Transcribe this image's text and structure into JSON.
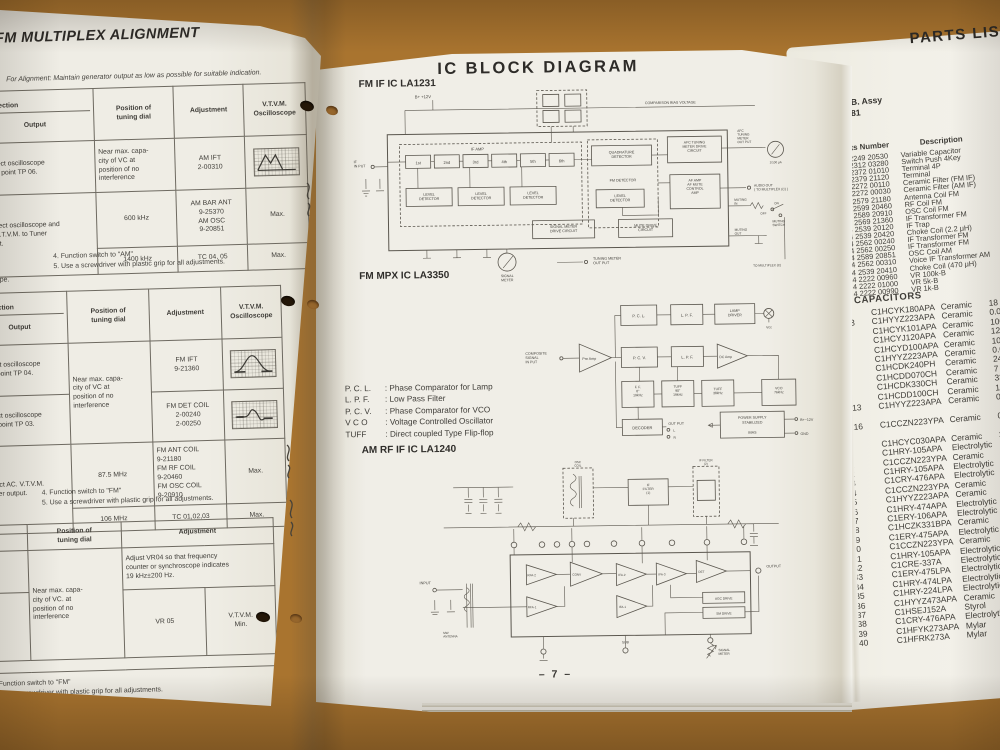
{
  "left_page": {
    "title": "FM MULTIPLEX ALIGNMENT",
    "alignment_note": "For Alignment: Maintain generator output as low as possible for suitable indication.",
    "cut_fragment": "ope.",
    "am_table": {
      "col_connection": "Connection",
      "col_output": "Output",
      "col_position": "Position of\ntuning dial",
      "col_adjustment": "Adjustment",
      "col_vtvm": "V.T.V.M.\nOscilloscope",
      "r1_connection": "Connect oscilloscope\nto test point TP 06.",
      "r1_position": "Near max. capa-\ncity of VC at\nposition of no\ninterference",
      "r1_adjustment": "AM IFT\n2-00310",
      "r2_connection": "Connect oscilloscope and\nAC. V.T.V.M. to Tuner\noutput.",
      "r2_position": "600 kHz",
      "r2_adjustment": "AM BAR ANT\n9-25370\nAM OSC\n9-20851",
      "r2_vtvm": "Max.",
      "r3_position": "1400 kHz",
      "r3_adjustment": "TC 04, 05",
      "r3_vtvm": "Max.",
      "footnote4": "4.  Function switch to \"AM\"",
      "footnote5": "5.  Use a screwdriver with plastic grip for all adjustments."
    },
    "fm_table": {
      "col_connection": "Connection",
      "col_output": "Output",
      "col_position": "Position of\ntuning dial",
      "col_adjustment": "Adjustment",
      "col_vtvm": "V.T.V.M.\nOscilloscope",
      "r1_connection": "Connect oscilloscope\nto test point TP 04.",
      "r1_position": "Near max. capa-\ncity of VC at\nposition of no\ninterference",
      "r1_adjustment": "FM IFT\n9-21360",
      "r2_connection": "Connect oscilloscope\nto test point TP 03.",
      "r2_adjustment": "FM DET COIL\n2-00240\n2-00250",
      "r3_connection": "Connect AC. V.T.V.M.\nto Tuner output.",
      "r3_position": "87.5 MHz",
      "r3_adjustment": "FM ANT COIL\n9-21180\nFM RF COIL\n9-20460\nFM OSC COIL\n9-20910",
      "r3_vtvm": "Max.",
      "r4_position": "106 MHz",
      "r4_adjustment": "TC 01,02,03",
      "r4_vtvm": "Max.",
      "footnote4": "4.  Function switch to \"FM\"",
      "footnote5": "5.  Use a screwdriver with plastic grip for all adjustments."
    },
    "mpx_table": {
      "col_position": "Position of\ntuning dial",
      "col_adjustment": "Adjustment",
      "r1_adjustment": "Adjust VR04 so that frequency\ncounter or synchroscope indicates\n19 kHz±200 Hz.",
      "r2_position": "Near max. capa-\ncity of VC. at\nposition of no\ninterference",
      "r2_adjustment": "VR 05",
      "r2_vtvm": "V.T.V.M.\nMin.",
      "footnote4": "4.  Function switch to \"FM\"",
      "footnote5": "5.  Use a screwdriver with plastic grip for all adjustments."
    }
  },
  "center_page": {
    "title": "IC BLOCK DIAGRAM",
    "page_number": "– 7 –",
    "la1231": {
      "heading": "FM IF IC LA1231",
      "b_plus": "B+  +12V",
      "comparison": "COMPARISON  BIAS  VOLTAGE",
      "if_input": "IF\nIN PUT",
      "if_amp": "IF  AMP",
      "stages": [
        "1st",
        "2nd",
        "3rd",
        "4th",
        "5th",
        "6th"
      ],
      "level_detector": "LEVEL\nDETECTOR",
      "quadrature": "QUADRATURE\nDETECTOR",
      "fm_detector": "FM  DETECTOR",
      "afc_block": "AFC TUNING\nMETER DRIVE\nCIRCUIT",
      "af_block": "AF  AMP\nAF MUTE\nCONTROL\nAMP",
      "sig_drive": "SIGNAL METER\nDRIVE CIRCUIT",
      "mute_drive": "MUTE DRIVE\nCIRCUIT",
      "signal_meter": "SIGNAL\nMETER",
      "tuning_meter_out": "TUNING  METER\nOUT PUT",
      "afc_out": "AFC\nTUNING\nMETER\nOUT PUT",
      "meter_scale": "1/100 μA",
      "audio_out": "AUDIO OUT\n( TO MULTIPLEX (C) )",
      "muting_in": "MUTING\nIN",
      "on": "ON",
      "off": "OFF",
      "muting_switch": "MUTING\nSWITCH",
      "muting_out": "MUTING\nOUT",
      "to_multiplex": "TO MULTIPLEX (C)"
    },
    "la3350": {
      "heading": "FM MPX IC LA3350",
      "composite": "COMPOSITE\nSIGNAL\nIN PUT",
      "pre_amp": "Pre Amp",
      "pcl": "P. C. L.",
      "lpf1": "L. P. F.",
      "lamp_driver": "LAMP\nDRIVER",
      "vcc": "Vcc",
      "pcv": "P. C. V.",
      "lpf2": "L. P. F.",
      "dc_amp": "DC Amp",
      "ff": "F. F.\n0°\n19kHz",
      "tuff90": "TUFF\n90°\n19kHz",
      "tuff38": "TUFF\n38kHz",
      "vco": "VCO\n76kHz",
      "decoder": "DECODER",
      "out_put": "OUT PUT",
      "out_l": "L",
      "out_r": "R",
      "power1": "POWER SUPPLY",
      "power2": "STABILIZED",
      "bias": "BIAS",
      "b12v": "B+~12V",
      "gnd": "GND"
    },
    "legend": [
      {
        "t": "P. C. L.",
        "d": ": Phase Comparator for Lamp"
      },
      {
        "t": "L. P. F.",
        "d": ": Low Pass Filter"
      },
      {
        "t": "P. C. V.",
        "d": ": Phase Comparator for VCO"
      },
      {
        "t": "V C O",
        "d": ": Voltage Controlled Oscillator"
      },
      {
        "t": "TUFF",
        "d": ": Direct coupled Type Flip-flop"
      }
    ],
    "la1240": {
      "heading": "AM RF IF IC LA1240",
      "input": "INPUT",
      "mw_antenna": "MW\nANTENNA",
      "osc_coil": "OSC\nCOIL",
      "if_filter1": "IF\nFILTER\n(1)",
      "if_filter2": "IF FILTER\n(2)",
      "rfa2": "RFA-2",
      "rfa1": "RFA-1",
      "conv": "CONV",
      "ifa2": "IFA-2",
      "ifa1": "IFA-1",
      "ifa3": "IFA-3",
      "det": "DET",
      "agc": "AGC DRIVE",
      "sm": "SM DRIVE",
      "sub": "SUB",
      "signal_meter": "SIGNAL\nMETER",
      "output": "OUTPUT"
    }
  },
  "right_page": {
    "title": "PARTS LIST",
    "assy_name": "RF/IF/MPX P.C.B. Assy",
    "assy_number": "131 0 4001 08781",
    "col_ref": "Ref.  No.",
    "col_part": "Parts Number",
    "col_desc": "Description",
    "parts": [
      [
        "",
        "4 2249 20530",
        "Variable Capacitor"
      ],
      [
        "",
        "4 2312 03280",
        "Switch Push 4Key"
      ],
      [
        "",
        "4 2372 01010",
        "Terminal 4P"
      ],
      [
        "",
        "4 2379 21120",
        "Terminal"
      ],
      [
        "CF01,02",
        "4 2272 00110",
        "Ceramic Filter (FM IF)"
      ],
      [
        "CF03",
        "4 2272 00030",
        "Ceramic Filter (AM IF)"
      ],
      [
        "L01",
        "4 2579 21180",
        "Antenna Coil FM"
      ],
      [
        "L02",
        "4 2599 20460",
        "RF Coil FM"
      ],
      [
        "L03",
        "4 2589 20910",
        "OSC Coil FM"
      ],
      [
        "L04",
        "4 2569 21360",
        "IF Transformer FM"
      ],
      [
        "L05",
        "4 2539 20120",
        "IF Trap"
      ],
      [
        "L06",
        "4 2539 20420",
        "Choke Coil (2.2 μH)"
      ],
      [
        "L07",
        "4 2562 00240",
        "IF Transformer FM"
      ],
      [
        "L08",
        "4 2562 00250",
        "IF Transformer FM"
      ],
      [
        "L10",
        "4 2589 20851",
        "OSC Coil AM"
      ],
      [
        "L12",
        "4 2562 00310",
        "Voice IF Transformer AM"
      ],
      [
        "L13",
        "4 2539 20410",
        "Choke Coil (470 μH)"
      ],
      [
        "VR02",
        "4 2222 00960",
        "VR 100k-B"
      ],
      [
        "VR04",
        "4 2222 01000",
        "VR 5k-B"
      ],
      [
        "VR05",
        "4 2222 00990",
        "VR 1k-B"
      ]
    ],
    "capacitors_heading": "CAPACITORS",
    "capacitors": [
      [
        "C01",
        "C1HCYK180APA",
        "Ceramic",
        "18 pF   50V"
      ],
      [
        "C02,03",
        "C1HYYZ223APA",
        "Ceramic",
        "0.022 μF  50V"
      ],
      [
        "C04",
        "C1HCYK101APA",
        "Ceramic",
        "100 pF   50V"
      ],
      [
        "C05",
        "C1HCYJ120APA",
        "Ceramic",
        "12 pF   50V"
      ],
      [
        "C06",
        "C1HCYD100APA",
        "Ceramic",
        "10 pF   50V"
      ],
      [
        "C07",
        "C1HYYZ223APA",
        "Ceramic",
        "0.022 μF  50V"
      ],
      [
        "C08",
        "C1HCDK240PH",
        "Ceramic",
        "24 pF   50V"
      ],
      [
        "C09",
        "C1HCDD070CH",
        "Ceramic",
        "7 pF   50V"
      ],
      [
        "C10",
        "C1HCDK330CH",
        "Ceramic",
        "33 pF   50V"
      ],
      [
        "C11",
        "C1HCDD100CH",
        "Ceramic",
        "10 pF   50V"
      ],
      [
        "C12,13\n14",
        "C1HYYZ223APA",
        "Ceramic",
        "0.022 μF  50V"
      ],
      [
        "C15,16\n17",
        "C1CCZN223YPA",
        "Ceramic",
        "0.022 μF  50V"
      ],
      [
        "C18",
        "C1HCYC030APA",
        "Ceramic",
        "3 pF   50V"
      ],
      [
        "C20",
        "C1HRY-105APA",
        "Electrolytic",
        ""
      ],
      [
        "C21",
        "C1CCZN223YPA",
        "Ceramic",
        "0.022 μF"
      ],
      [
        "C22",
        "C1HRY-105APA",
        "Electrolytic",
        ""
      ],
      [
        "C23",
        "C1CRY-476APA",
        "Electrolytic",
        ""
      ],
      [
        "C24",
        "C1CCZN223YPA",
        "Ceramic",
        "0.022 μF"
      ],
      [
        "C25",
        "C1HYYZ223APA",
        "Ceramic",
        "0.022 μF"
      ],
      [
        "C26",
        "C1HRY-474APA",
        "Electrolytic",
        ""
      ],
      [
        "C27",
        "C1ERY-106APA",
        "Electrolytic",
        ""
      ],
      [
        "C28",
        "C1HCZK331BPA",
        "Ceramic",
        ""
      ],
      [
        "C29",
        "C1ERY-475APA",
        "Electrolytic",
        ""
      ],
      [
        "C30",
        "C1CCZN223YPA",
        "Ceramic",
        "0.022"
      ],
      [
        "C31",
        "C1HRY-105APA",
        "Electrolytic",
        ""
      ],
      [
        "C32",
        "C1CRE-337A",
        "Electrolytic",
        ""
      ],
      [
        "C33",
        "C1ERY-475LPA",
        "Electrolytic",
        ""
      ],
      [
        "C34",
        "C1HRY-474LPA",
        "Electrolytic",
        ""
      ],
      [
        "C35",
        "C1HRY-224LPA",
        "Electrolytic",
        ""
      ],
      [
        "C36",
        "C1HYYZ473APA",
        "Ceramic",
        ""
      ],
      [
        "C37",
        "C1HSEJ152A",
        "Styrol",
        ""
      ],
      [
        "C38",
        "C1CRY-476APA",
        "Electrolytic",
        ""
      ],
      [
        "C39",
        "C1HFYK273APA",
        "Mylar",
        ""
      ],
      [
        "C40",
        "C1HFRK273A",
        "Mylar",
        ""
      ]
    ]
  }
}
